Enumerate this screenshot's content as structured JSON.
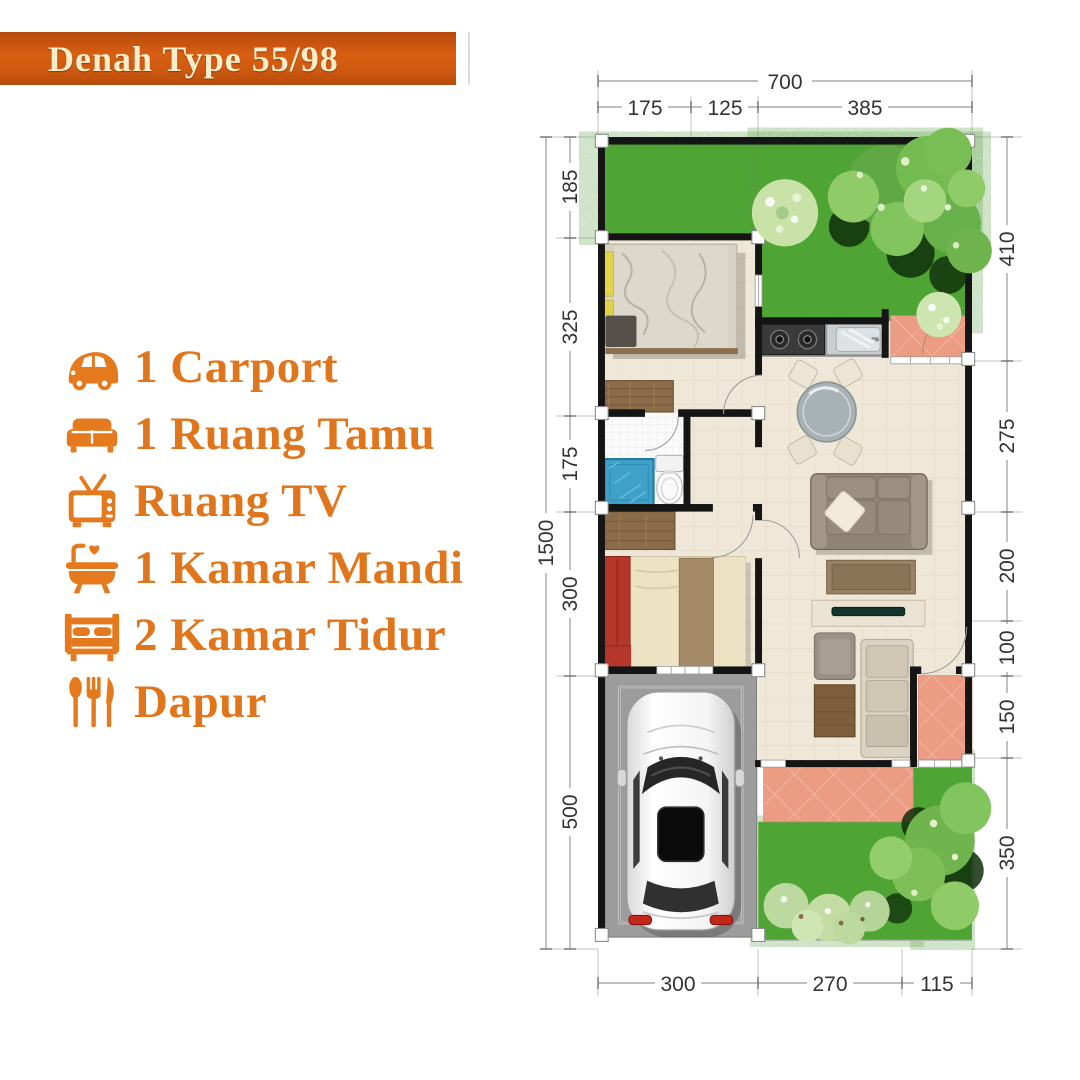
{
  "banner": {
    "title": "Denah Type 55/98",
    "bg_top": "#b5490c",
    "bg_mid": "#d85f12",
    "text_color": "#f6edcb"
  },
  "legend": {
    "accent": "#e5791e",
    "items": [
      {
        "icon": "car-icon",
        "label": "1 Carport"
      },
      {
        "icon": "sofa-icon",
        "label": "1 Ruang Tamu"
      },
      {
        "icon": "tv-icon",
        "label": "Ruang TV"
      },
      {
        "icon": "bathtub-icon",
        "label": "1 Kamar Mandi"
      },
      {
        "icon": "bed-icon",
        "label": "2 Kamar Tidur"
      },
      {
        "icon": "cutlery-icon",
        "label": "Dapur"
      }
    ]
  },
  "plan": {
    "dims": {
      "top_total": "700",
      "top": [
        "175",
        "125",
        "385"
      ],
      "left_total": "1500",
      "left": [
        "185",
        "325",
        "175",
        "300",
        "500"
      ],
      "right": [
        "410",
        "275",
        "200",
        "100",
        "150",
        "350"
      ],
      "bottom": [
        "300",
        "270",
        "115"
      ]
    }
  },
  "colors": {
    "wall": "#151515",
    "floor": "#efe8d8",
    "bath_floor": "#fbfbfb",
    "lawn": "#4ca82f",
    "terrace": "#ec9c83",
    "carport": "#9c9c9c",
    "shower": "#3fa0c8",
    "bed_red": "#b4372a",
    "wood": "#8a6c49",
    "sofa": "#8f8476",
    "dim_text": "#333333"
  }
}
